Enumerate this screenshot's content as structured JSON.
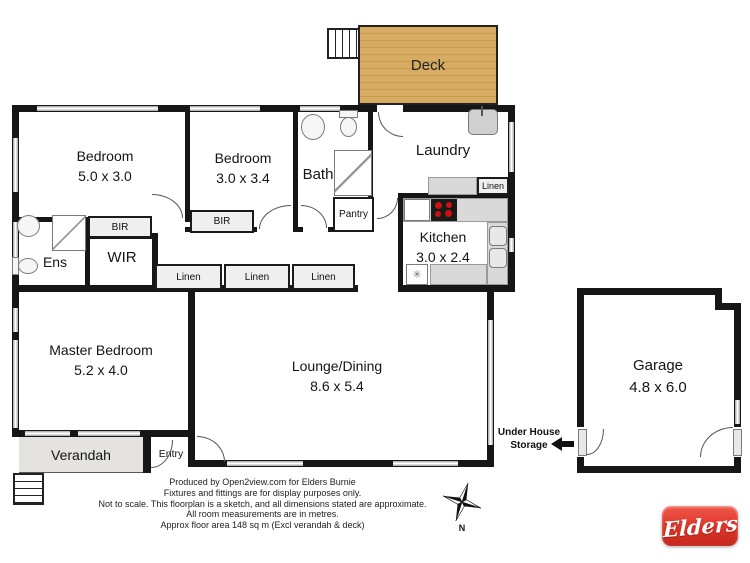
{
  "rooms": {
    "deck": {
      "label": "Deck"
    },
    "bedroom1": {
      "label": "Bedroom",
      "dims": "5.0 x 3.0"
    },
    "bedroom2": {
      "label": "Bedroom",
      "dims": "3.0 x 3.4"
    },
    "bath": {
      "label": "Bath"
    },
    "laundry": {
      "label": "Laundry"
    },
    "kitchen": {
      "label": "Kitchen",
      "dims": "3.0 x 2.4"
    },
    "ens": {
      "label": "Ens"
    },
    "wir": {
      "label": "WIR"
    },
    "master": {
      "label": "Master Bedroom",
      "dims": "5.2 x 4.0"
    },
    "lounge": {
      "label": "Lounge/Dining",
      "dims": "8.6 x 5.4"
    },
    "verandah": {
      "label": "Verandah"
    },
    "entry": {
      "label": "Entry"
    },
    "garage": {
      "label": "Garage",
      "dims": "4.8 x 6.0"
    }
  },
  "cupboards": {
    "bir1": "BIR",
    "bir2": "BIR",
    "linen1": "Linen",
    "linen2": "Linen",
    "linen3": "Linen",
    "linen_laundry": "Linen",
    "pantry": "Pantry"
  },
  "annotations": {
    "storage_line1": "Under House",
    "storage_line2": "Storage",
    "compass_north": "N"
  },
  "footer": {
    "lines": [
      "Produced by Open2view.com for Elders Burnie",
      "Fixtures and fittings are for display purposes only.",
      "Not to scale. This floorplan is a sketch, and all dimensions stated are approximate.",
      "All room measurements are in metres.",
      "Approx floor area 148 sq m (Excl verandah & deck)"
    ]
  },
  "logo": {
    "text": "Elders"
  },
  "colors": {
    "deck_wood": "#d7ac62",
    "verandah_grey": "#e4e3df",
    "wall_black": "#161616",
    "window_grey": "#b5b5b5",
    "logo_red": "#dd3226",
    "stove_burner": "#cc1111"
  }
}
